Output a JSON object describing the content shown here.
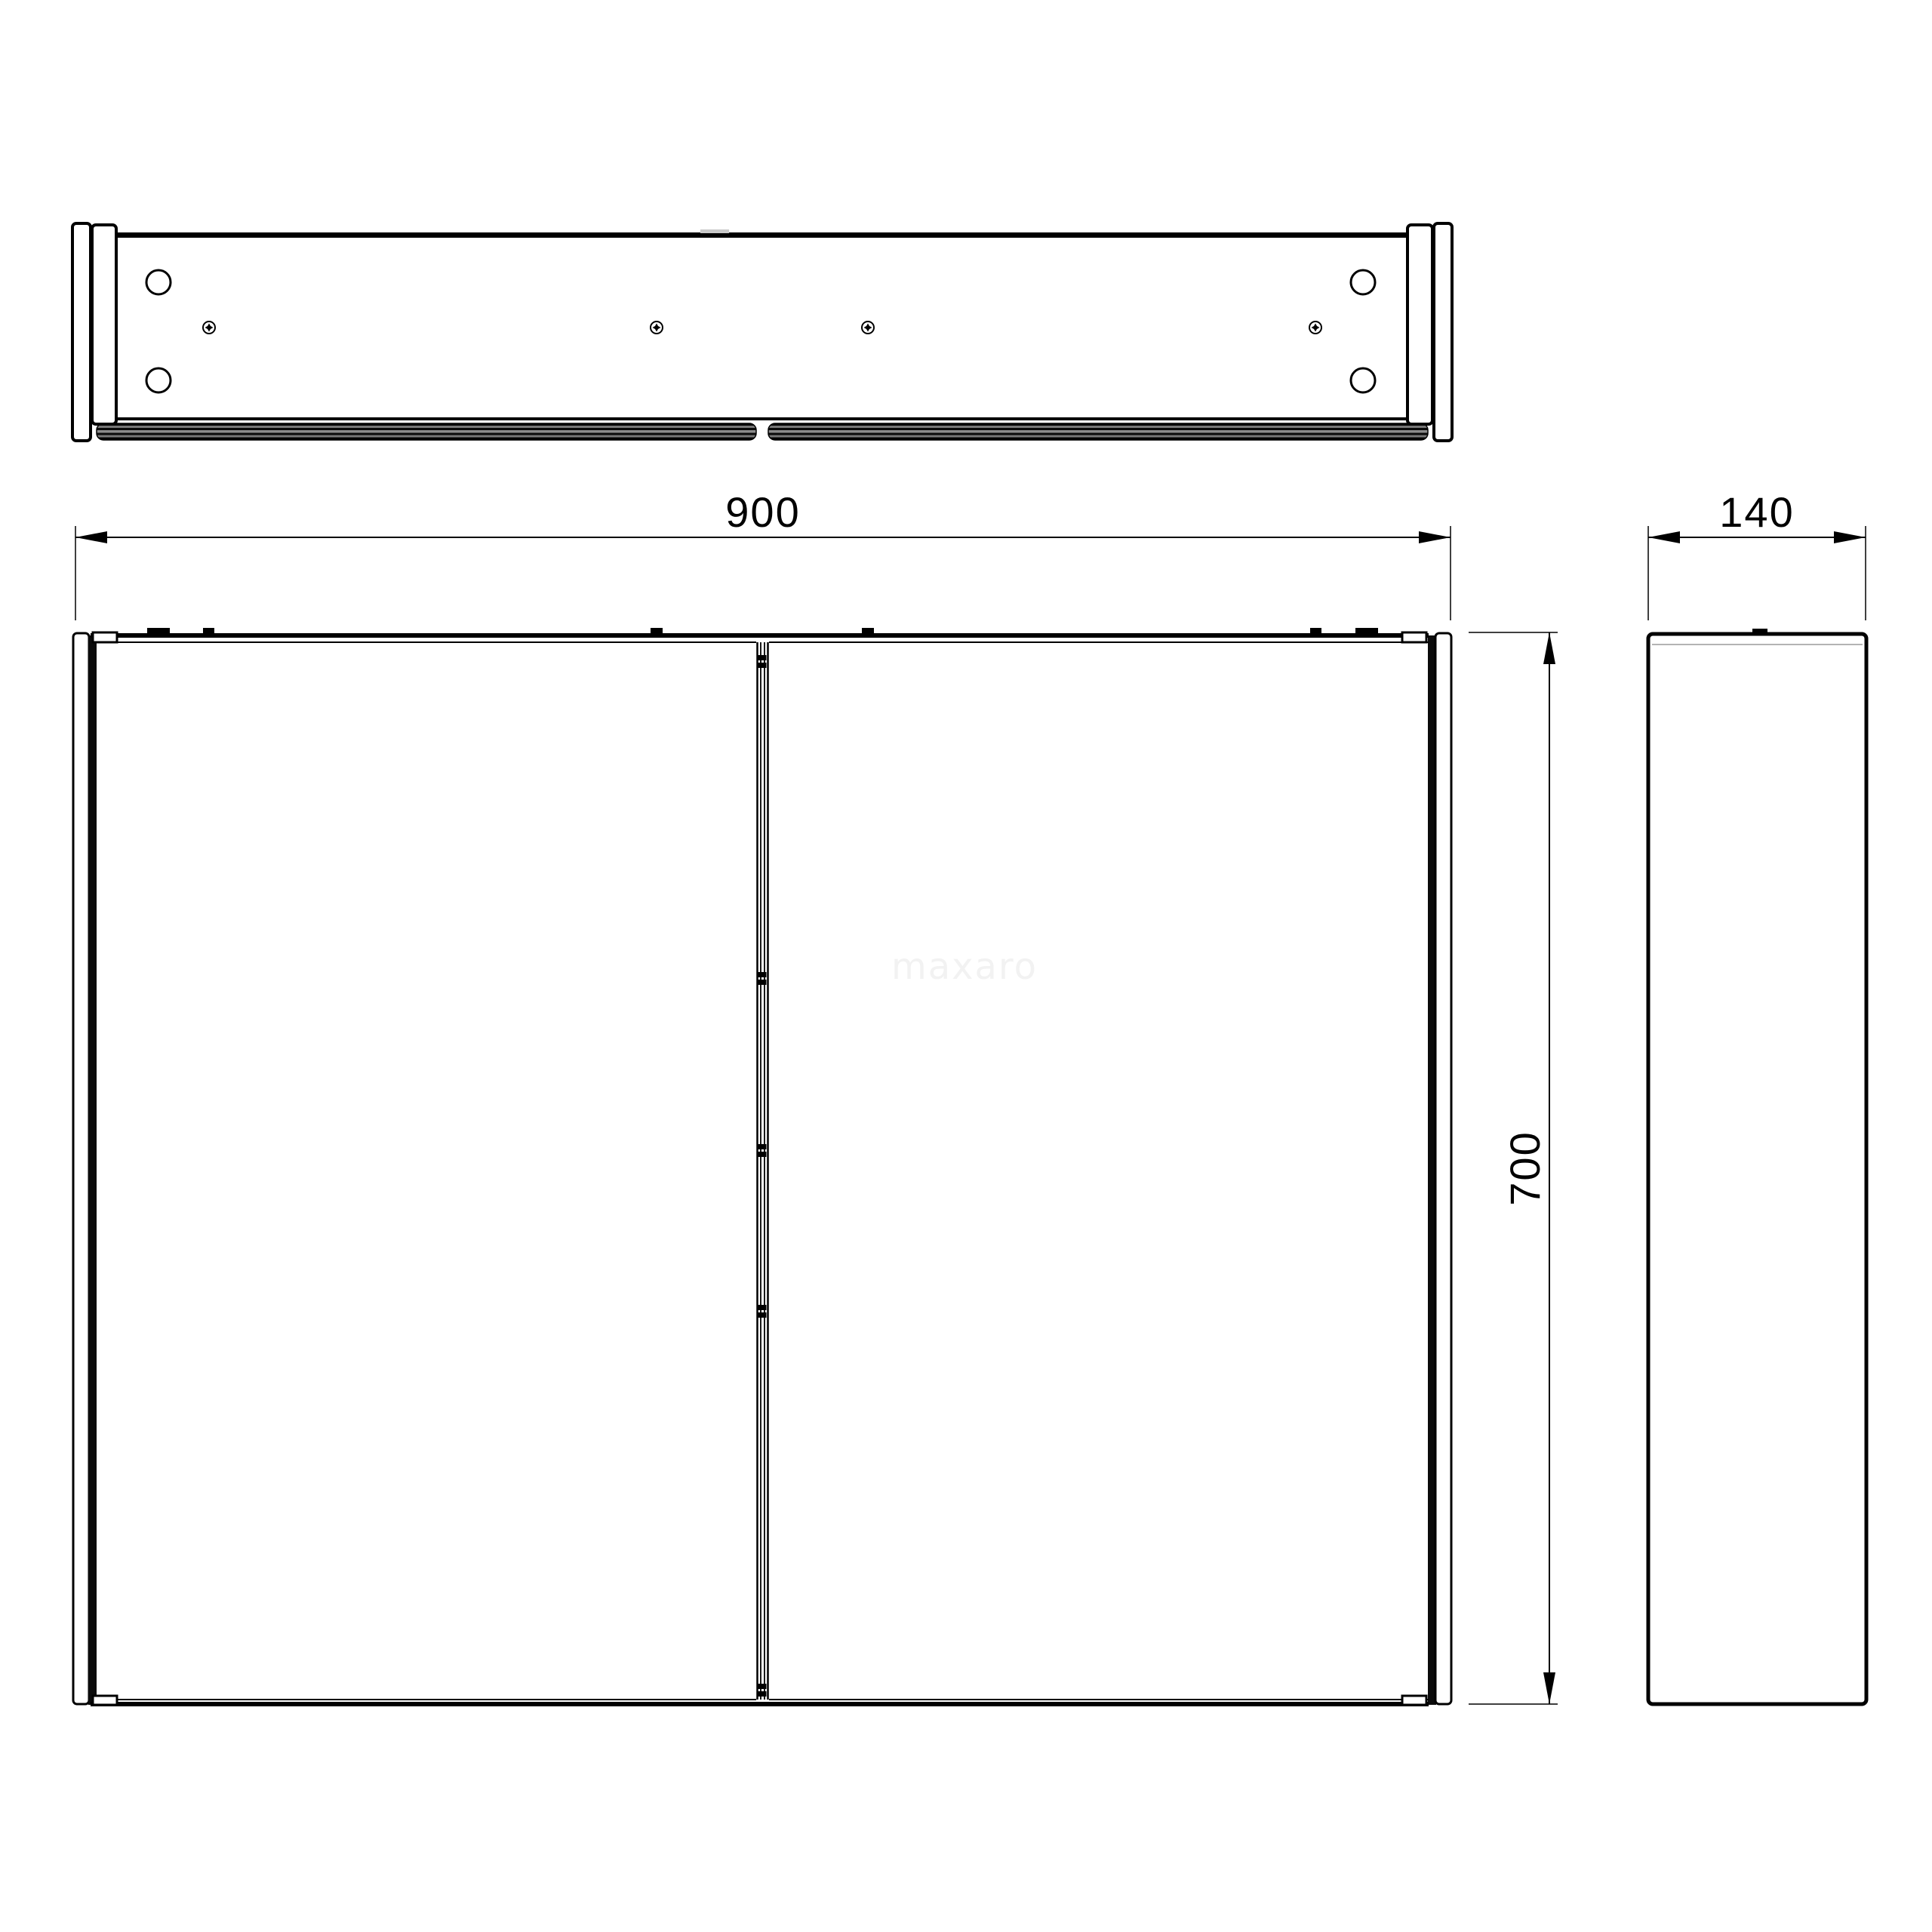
{
  "watermark": "maxaro",
  "dimensions": {
    "width": "900",
    "depth": "140",
    "height": "700"
  },
  "colors": {
    "line": "#000000",
    "watermark_gray": "#f2f2f2",
    "mirror_stripe_dark": "#111111",
    "mirror_stripe_mid": "#6f6f6f"
  }
}
